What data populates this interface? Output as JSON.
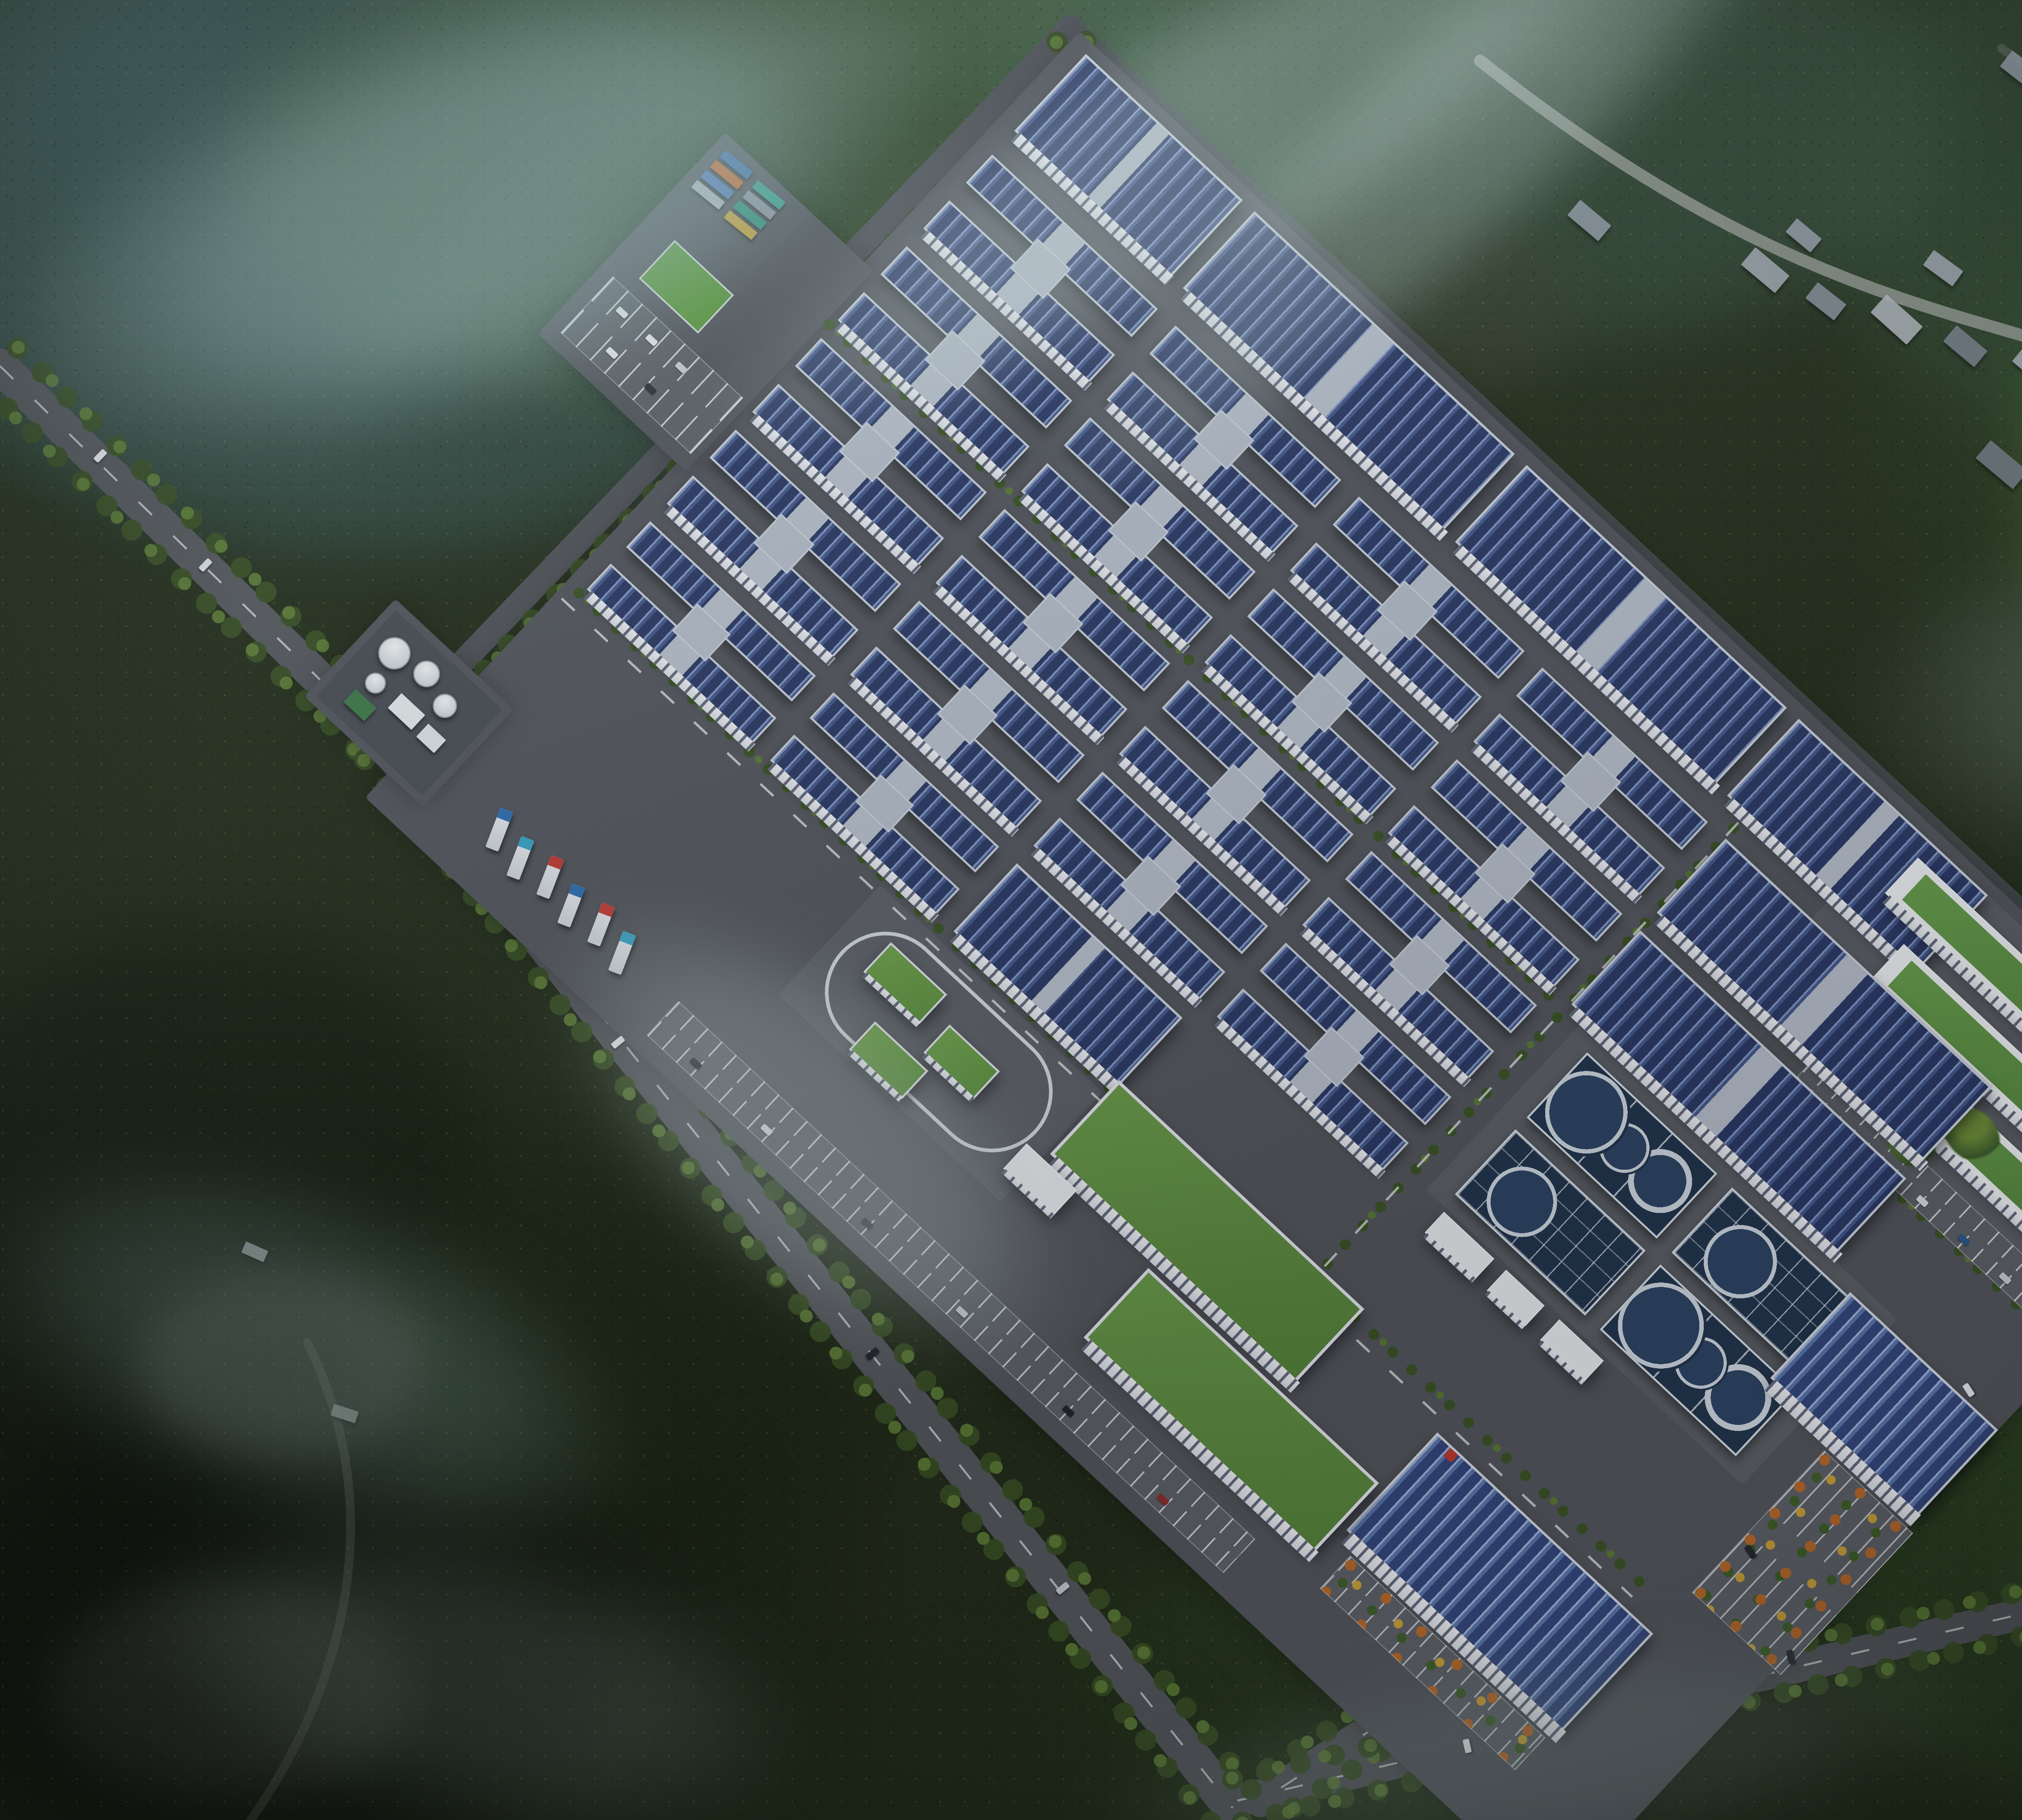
{
  "scene": {
    "width": 6000,
    "height": 4500,
    "colors": {
      "forest_base": "#27331f",
      "asphalt": "#54575e",
      "panel_blue": "#32447a",
      "panel_stripe": "#8094c2",
      "roof_gray": "#b7bfcc",
      "facade_white": "#eef1f5",
      "green_roof": "#5e8c42",
      "water_basin": "#24374f",
      "autumn_orange": "#b96a2c",
      "autumn_yellow": "#caa23a",
      "mist": "#a8c6c8"
    }
  },
  "forest_blobs": [
    [
      -200,
      -150,
      2200,
      1500,
      "#3f5e5f",
      0.55,
      80
    ],
    [
      600,
      -200,
      2600,
      1200,
      "#49654a",
      0.5,
      90
    ],
    [
      2450,
      -250,
      2400,
      1100,
      "#41604f",
      0.45,
      90
    ],
    [
      4500,
      -200,
      1800,
      1300,
      "#35503a",
      0.5,
      90
    ],
    [
      5000,
      500,
      1300,
      1300,
      "#4c6c34",
      0.5,
      70
    ],
    [
      5200,
      1700,
      1100,
      1600,
      "#3a5a2c",
      0.5,
      80
    ],
    [
      4500,
      3300,
      1800,
      1200,
      "#314927",
      0.55,
      80
    ],
    [
      2600,
      3800,
      1500,
      800,
      "#2a3d22",
      0.5,
      80
    ],
    [
      -200,
      2300,
      1400,
      1200,
      "#141c10",
      0.65,
      90
    ],
    [
      -100,
      3400,
      1600,
      1200,
      "#10160d",
      0.7,
      100
    ],
    [
      900,
      2900,
      1200,
      900,
      "#1c2715",
      0.6,
      90
    ],
    [
      1500,
      200,
      1200,
      900,
      "#2c4124",
      0.5,
      80
    ],
    [
      3000,
      500,
      900,
      500,
      "#3a4030",
      0.5,
      60
    ],
    [
      350,
      3150,
      700,
      450,
      "#555a52",
      0.4,
      50
    ],
    [
      120,
      3920,
      900,
      520,
      "#4a4e49",
      0.4,
      60
    ],
    [
      2050,
      4100,
      900,
      500,
      "#232e1c",
      0.5,
      70
    ]
  ],
  "roads": [
    {
      "d": "M 0 905 L 952 1838",
      "w": 86,
      "c": "#56595f",
      "dash": true,
      "trees": [
        [
          43,
          -44
        ],
        [
          -43,
          44
        ]
      ]
    },
    {
      "d": "M 952 1838 L 3048 4470",
      "w": 92,
      "c": "#55585e",
      "dash": true,
      "trees": [
        [
          50,
          -40
        ],
        [
          -50,
          40
        ]
      ]
    },
    {
      "d": "M 2648 66 L 952 1838",
      "w": 60,
      "c": "#51545a",
      "dash": false,
      "trees": [
        [
          38,
          36
        ]
      ]
    },
    {
      "d": "M 2648 66 L 5632 2842",
      "w": 54,
      "c": "#4e5258",
      "op": 0.85,
      "trees": [
        [
          -34,
          37
        ]
      ]
    },
    {
      "d": "M 5632 2842 L 3118 4452",
      "w": 82,
      "c": "#54575d",
      "dash": true,
      "trees": [
        [
          -31,
          -48
        ],
        [
          31,
          48
        ]
      ]
    },
    {
      "d": "M 3060 4452 C 3900 4256 5000 3978 6000 3768",
      "w": 78,
      "c": "#53565c",
      "dash": true,
      "trees": [
        [
          -12,
          -53
        ],
        [
          12,
          53
        ]
      ]
    },
    {
      "d": "M 3660 150 C 4150 540 4520 690 4900 800 C 5280 910 5600 1010 5870 1085",
      "w": 30,
      "c": "#9aa09a",
      "op": 0.8,
      "trees": []
    },
    {
      "d": "M 760 3320 C 960 3720 860 4160 620 4500",
      "w": 22,
      "c": "#707468",
      "op": 0.3,
      "trees": []
    },
    {
      "d": "M 4950 120 C 5150 260 5400 420 5830 560",
      "w": 22,
      "c": "#8b9089",
      "op": 0.35,
      "trees": []
    }
  ],
  "village_houses": [
    [
      4310,
      640,
      110,
      56,
      40,
      "#a9b0ba"
    ],
    [
      4470,
      720,
      90,
      50,
      38,
      "#8d95a1"
    ],
    [
      4630,
      760,
      120,
      60,
      42,
      "#b6bcc4"
    ],
    [
      4810,
      830,
      100,
      52,
      40,
      "#7c8490"
    ],
    [
      4980,
      880,
      130,
      62,
      40,
      "#aeb5bf"
    ],
    [
      5160,
      930,
      90,
      48,
      38,
      "#98a0ac"
    ],
    [
      5330,
      980,
      110,
      54,
      42,
      "#868e9a"
    ],
    [
      4420,
      560,
      80,
      44,
      40,
      "#9aa2ae"
    ],
    [
      4760,
      640,
      90,
      46,
      36,
      "#a4abb6"
    ],
    [
      5060,
      740,
      84,
      44,
      40,
      "#8f97a3"
    ],
    [
      4890,
      1120,
      120,
      58,
      40,
      "#79818d"
    ],
    [
      5120,
      1180,
      100,
      50,
      38,
      "#a9b0ba"
    ],
    [
      5340,
      1230,
      90,
      48,
      40,
      "#9198a4"
    ],
    [
      4950,
      150,
      100,
      50,
      38,
      "#9aa1ad"
    ],
    [
      5120,
      210,
      90,
      46,
      40,
      "#aab1bb"
    ],
    [
      5300,
      280,
      110,
      52,
      38,
      "#848c98"
    ],
    [
      5470,
      350,
      90,
      46,
      40,
      "#9ba2ae"
    ],
    [
      3880,
      520,
      100,
      50,
      40,
      "#98a0ac"
    ],
    [
      600,
      3080,
      60,
      30,
      24,
      "#9aa0a2"
    ],
    [
      820,
      3480,
      64,
      30,
      18,
      "#8d9294"
    ]
  ],
  "campus": {
    "x": 2640,
    "y": 50,
    "w": 4100,
    "h": 2700,
    "angle": 43,
    "items": [
      {
        "t": "pad",
        "x": 40,
        "y": 0,
        "w": 4020,
        "h": 2590
      },
      {
        "t": "pad",
        "x": -430,
        "y": 780,
        "w": 500,
        "h": 680
      },
      {
        "t": "pad",
        "x": -240,
        "y": 2180,
        "w": 400,
        "h": 330
      },
      {
        "t": "pad2",
        "x": 2860,
        "y": 30,
        "w": 1180,
        "h": 600
      },
      {
        "t": "pad2",
        "x": 2620,
        "y": 950,
        "w": 1070,
        "h": 560
      },
      {
        "t": "pad2",
        "x": 1120,
        "y": 1880,
        "w": 750,
        "h": 370
      },
      {
        "t": "tl",
        "x": 60,
        "y": 1838,
        "w": 3620,
        "h": 44
      },
      {
        "t": "tl",
        "x": 60,
        "y": 930,
        "w": 2480,
        "h": 40
      },
      {
        "t": "tlv",
        "x": 2545,
        "y": 60,
        "w": 44,
        "h": 1780
      },
      {
        "t": "tl",
        "x": 3090,
        "y": 700,
        "w": 940,
        "h": 40
      },
      {
        "t": "lane",
        "x": 60,
        "y": 1896,
        "w": 3620,
        "h": 6
      },
      {
        "t": "lanev",
        "x": 2563,
        "y": 60,
        "w": 6,
        "h": 1760
      },
      {
        "t": "slab",
        "x": 90,
        "y": 30,
        "w": 530,
        "h": 260
      },
      {
        "t": "slab",
        "x": 660,
        "y": 30,
        "w": 880,
        "h": 260
      },
      {
        "t": "slab",
        "x": 1580,
        "y": 30,
        "w": 880,
        "h": 260
      },
      {
        "t": "slab",
        "x": 2500,
        "y": 30,
        "w": 640,
        "h": 260
      },
      {
        "t": "office",
        "x": 2950,
        "y": 80,
        "w": 770,
        "h": 120
      },
      {
        "t": "office",
        "x": 3070,
        "y": 260,
        "w": 770,
        "h": 120
      },
      {
        "t": "office",
        "x": 3190,
        "y": 440,
        "w": 770,
        "h": 120
      },
      {
        "t": "park",
        "x": 3100,
        "y": 620,
        "w": 840,
        "h": 100,
        "cars": [
          [
            40,
            64,
            "#d9dde2"
          ],
          [
            130,
            64,
            "#30343b"
          ],
          [
            260,
            64,
            "#8f2f2f"
          ],
          [
            420,
            64,
            "#d9dde2"
          ],
          [
            560,
            64,
            "#2f5a8f"
          ],
          [
            700,
            64,
            "#caced3"
          ]
        ]
      },
      {
        "t": "tb",
        "x": 3480,
        "y": 110,
        "w": 150,
        "h": 120
      },
      {
        "t": "tb",
        "x": 3650,
        "y": 260,
        "w": 170,
        "h": 130
      },
      {
        "t": "tb",
        "x": 3440,
        "y": 430,
        "w": 150,
        "h": 120
      },
      {
        "t": "tb",
        "x": 3810,
        "y": 480,
        "w": 160,
        "h": 120
      },
      {
        "t": "tb",
        "x": 3950,
        "y": 150,
        "w": 140,
        "h": 110
      },
      {
        "t": "tb",
        "x": 3350,
        "y": 560,
        "w": 140,
        "h": 100
      },
      {
        "t": "h",
        "x": 90,
        "y": 370,
        "w": 560,
        "h": 250
      },
      {
        "t": "h",
        "x": 710,
        "y": 370,
        "w": 560,
        "h": 250
      },
      {
        "t": "h",
        "x": 1330,
        "y": 370,
        "w": 560,
        "h": 250
      },
      {
        "t": "h",
        "x": 1950,
        "y": 370,
        "w": 560,
        "h": 250
      },
      {
        "t": "slab",
        "x": 2570,
        "y": 370,
        "w": 900,
        "h": 250
      },
      {
        "t": "h",
        "x": 90,
        "y": 680,
        "w": 560,
        "h": 250
      },
      {
        "t": "h",
        "x": 710,
        "y": 680,
        "w": 560,
        "h": 250
      },
      {
        "t": "h",
        "x": 1330,
        "y": 680,
        "w": 560,
        "h": 250
      },
      {
        "t": "h",
        "x": 1950,
        "y": 680,
        "w": 560,
        "h": 250
      },
      {
        "t": "slab",
        "x": 2570,
        "y": 680,
        "w": 900,
        "h": 250
      },
      {
        "t": "h",
        "x": 90,
        "y": 990,
        "w": 560,
        "h": 250
      },
      {
        "t": "h",
        "x": 710,
        "y": 990,
        "w": 560,
        "h": 250
      },
      {
        "t": "h",
        "x": 1330,
        "y": 990,
        "w": 560,
        "h": 250
      },
      {
        "t": "h",
        "x": 1950,
        "y": 990,
        "w": 560,
        "h": 250
      },
      {
        "t": "h",
        "x": 90,
        "y": 1300,
        "w": 560,
        "h": 250
      },
      {
        "t": "h",
        "x": 710,
        "y": 1300,
        "w": 560,
        "h": 250
      },
      {
        "t": "h",
        "x": 1330,
        "y": 1300,
        "w": 560,
        "h": 250
      },
      {
        "t": "h",
        "x": 1950,
        "y": 1300,
        "w": 560,
        "h": 250
      },
      {
        "t": "h",
        "x": 90,
        "y": 1610,
        "w": 560,
        "h": 230
      },
      {
        "t": "h",
        "x": 710,
        "y": 1610,
        "w": 560,
        "h": 230
      },
      {
        "t": "slab",
        "x": 1330,
        "y": 1610,
        "w": 560,
        "h": 230
      },
      {
        "t": "wta",
        "x": 2680,
        "y": 990,
        "w": 440,
        "h": 220
      },
      {
        "t": "wtb",
        "x": 3170,
        "y": 990,
        "w": 460,
        "h": 220
      },
      {
        "t": "wtb",
        "x": 2680,
        "y": 1250,
        "w": 440,
        "h": 220
      },
      {
        "t": "wta",
        "x": 3170,
        "y": 1250,
        "w": 460,
        "h": 220
      },
      {
        "t": "sw",
        "x": 2690,
        "y": 1520,
        "w": 170,
        "h": 70
      },
      {
        "t": "sw",
        "x": 2900,
        "y": 1520,
        "w": 130,
        "h": 70
      },
      {
        "t": "sw",
        "x": 3080,
        "y": 1520,
        "w": 150,
        "h": 70
      },
      {
        "t": "wh",
        "x": 3560,
        "y": 980,
        "w": 500,
        "h": 290
      },
      {
        "t": "parka",
        "x": 3780,
        "y": 1310,
        "w": 300,
        "h": 480
      },
      {
        "t": "wh",
        "x": 3050,
        "y": 1930,
        "w": 730,
        "h": 330,
        "logo": true
      },
      {
        "t": "parka",
        "x": 3100,
        "y": 2300,
        "w": 660,
        "h": 110
      },
      {
        "t": "loop",
        "x": 1160,
        "y": 1915,
        "w": 660,
        "h": 300
      },
      {
        "t": "pav",
        "x": 1235,
        "y": 1965,
        "w": 190,
        "h": 100
      },
      {
        "t": "pav",
        "x": 1480,
        "y": 2015,
        "w": 170,
        "h": 95
      },
      {
        "t": "pav",
        "x": 1340,
        "y": 2135,
        "w": 180,
        "h": 95
      },
      {
        "t": "green",
        "x": 1880,
        "y": 1830,
        "w": 830,
        "h": 250
      },
      {
        "t": "green",
        "x": 2250,
        "y": 2120,
        "w": 780,
        "h": 235
      },
      {
        "t": "sw",
        "x": 1820,
        "y": 2100,
        "w": 170,
        "h": 85
      },
      {
        "t": "park",
        "x": 950,
        "y": 2430,
        "w": 1950,
        "h": 115,
        "cars": [
          [
            120,
            74,
            "#23272e"
          ],
          [
            360,
            74,
            "#d9dde2"
          ],
          [
            700,
            74,
            "#3b4048"
          ],
          [
            1020,
            74,
            "#caced3"
          ],
          [
            1380,
            74,
            "#23272e"
          ],
          [
            1700,
            74,
            "#8f2f2f"
          ]
        ]
      },
      {
        "t": "tyard",
        "x": 300,
        "y": 2340,
        "w": 560,
        "h": 230
      },
      {
        "t": "util",
        "x": -220,
        "y": 2200,
        "w": 360,
        "h": 290
      },
      {
        "t": "cyard",
        "x": -410,
        "y": 800,
        "w": 460,
        "h": 200
      },
      {
        "t": "field",
        "x": -340,
        "y": 1060,
        "w": 200,
        "h": 130
      },
      {
        "t": "park",
        "x": -390,
        "y": 1230,
        "w": 440,
        "h": 190,
        "cars": [
          [
            60,
            40,
            "#e8ebee"
          ],
          [
            160,
            40,
            "#e8ebee"
          ],
          [
            260,
            40,
            "#caced3"
          ],
          [
            110,
            130,
            "#e8ebee"
          ],
          [
            240,
            130,
            "#30343b"
          ]
        ]
      }
    ],
    "truck_colors": [
      "#2f6fb3",
      "#3aa3c9",
      "#c23b36",
      "#2f6fb3",
      "#c23b36",
      "#3aa3c9"
    ],
    "container_colors": [
      "#3f6fa8",
      "#3aa08f",
      "#c96a2e",
      "#8b93a0",
      "#4f7ab8",
      "#2f8f7a",
      "#b0b6bd",
      "#c9a23a"
    ],
    "tanks": [
      [
        30,
        40,
        74
      ],
      [
        130,
        30,
        60
      ],
      [
        220,
        60,
        54
      ],
      [
        60,
        140,
        46
      ]
    ],
    "uboxes": [
      [
        150,
        140,
        80,
        50,
        "#e6eaee"
      ],
      [
        250,
        150,
        60,
        44,
        "#dfe3e8"
      ],
      [
        60,
        210,
        70,
        44,
        "#3f7a4a"
      ]
    ]
  },
  "road_cars": [
    [
      1520,
      2560,
      51,
      "#e8ebee"
    ],
    [
      2150,
      3330,
      51,
      "#20242b"
    ],
    [
      2620,
      3910,
      51,
      "#c4c9cf"
    ],
    [
      3620,
      4300,
      -13,
      "#e8ebee"
    ],
    [
      4420,
      4080,
      -13,
      "#2a2f36"
    ],
    [
      5240,
      3890,
      -13,
      "#d2d6db"
    ],
    [
      240,
      1110,
      44,
      "#eef1f4"
    ],
    [
      500,
      1380,
      44,
      "#dfe3e8"
    ],
    [
      4860,
      3420,
      -33,
      "#e8ebee"
    ],
    [
      4320,
      3820,
      -33,
      "#262b33"
    ]
  ],
  "mists": [
    [
      0,
      0,
      2400,
      1000,
      "rgba(168,198,200,.45)",
      70,
      -18
    ],
    [
      1600,
      0,
      2800,
      700,
      "rgba(205,224,226,.32)",
      60,
      -30
    ],
    [
      2300,
      60,
      2600,
      560,
      "rgba(198,218,220,.30)",
      50,
      -42
    ],
    [
      4600,
      1300,
      1700,
      900,
      "rgba(180,205,198,.22)",
      80,
      0
    ],
    [
      1250,
      2450,
      1500,
      720,
      "rgba(200,218,218,.30)",
      70,
      40
    ],
    [
      -100,
      2950,
      1700,
      800,
      "rgba(140,175,168,.28)",
      80,
      20
    ],
    [
      300,
      3800,
      1700,
      700,
      "rgba(160,188,182,.22)",
      80,
      12
    ],
    [
      2700,
      4100,
      2200,
      500,
      "rgba(150,175,170,.20)",
      80,
      -8
    ],
    [
      5000,
      3500,
      1200,
      900,
      "rgba(140,168,160,.22)",
      90,
      0
    ]
  ]
}
